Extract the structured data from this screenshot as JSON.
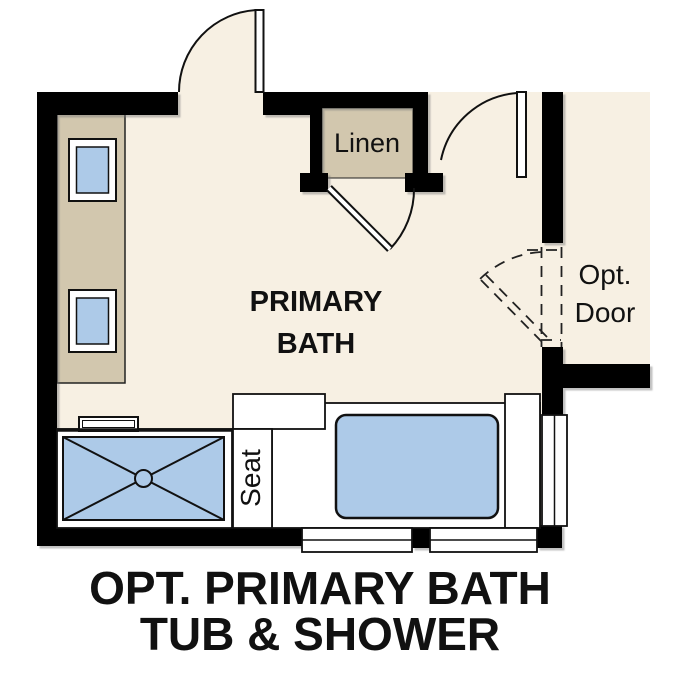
{
  "plan": {
    "room_label": {
      "line1": "PRIMARY",
      "line2": "BATH"
    },
    "linen_label": "Linen",
    "opt_door_label": {
      "line1": "Opt.",
      "line2": "Door"
    },
    "seat_label": "Seat"
  },
  "caption": {
    "line1": "OPT. PRIMARY BATH",
    "line2": "TUB & SHOWER"
  },
  "colors": {
    "floor": "#f7f0e3",
    "cabinet": "#d2c7ae",
    "fixture_blue": "#adcae8",
    "wall": "#000000",
    "outline": "#111111",
    "background": "#ffffff"
  }
}
